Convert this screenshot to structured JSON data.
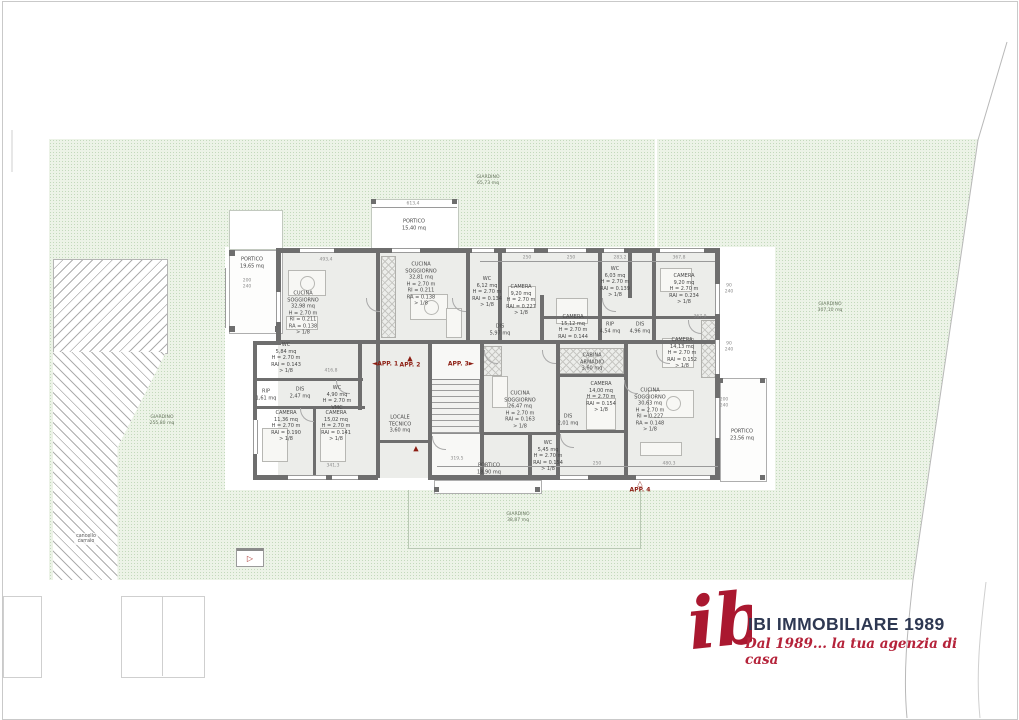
{
  "colors": {
    "wall_grey": "#6e6e6e",
    "garden_green": "#ecf3e7",
    "marker_red": "#8c1d12",
    "logo_red": "#aa1830",
    "logo_navy": "#2e3852"
  },
  "garden": {
    "labels": [
      {
        "id": "garden-top",
        "text": "GIARDINO\n65,73 mq",
        "x": 488,
        "y": 181
      },
      {
        "id": "garden-right",
        "text": "GIARDINO\n307,10 mq",
        "x": 830,
        "y": 308
      },
      {
        "id": "garden-left",
        "text": "GIARDINO\n255,80 mq",
        "x": 162,
        "y": 421
      },
      {
        "id": "garden-bottom",
        "text": "GIARDINO\n38,87 mq",
        "x": 518,
        "y": 518
      }
    ],
    "gate_label": "cancello\ncarraio"
  },
  "rooms": [
    {
      "id": "portico-tl",
      "x": 252,
      "y": 263,
      "lines": [
        "PORTICO",
        "19,65 mq"
      ]
    },
    {
      "id": "portico-top",
      "x": 414,
      "y": 225,
      "lines": [
        "PORTICO",
        "15,40 mq"
      ]
    },
    {
      "id": "cucina-app1",
      "x": 303,
      "y": 313,
      "lines": [
        "CUCINA",
        "SOGGIORNO",
        "32,98 mq",
        "H = 2.70 m",
        "RI = 0.211",
        "RA = 0.138",
        "> 1/8"
      ]
    },
    {
      "id": "cucina-app2",
      "x": 421,
      "y": 284,
      "lines": [
        "CUCINA",
        "SOGGIORNO",
        "32,81 mq",
        "H = 2.70 m",
        "RI = 0.211",
        "RA = 0.138",
        "> 1/8"
      ]
    },
    {
      "id": "wc-612",
      "x": 487,
      "y": 292,
      "lines": [
        "WC",
        "6,12 mq",
        "H = 2.70 m",
        "RAI = 0.134",
        "> 1/8"
      ]
    },
    {
      "id": "camera-920l",
      "x": 521,
      "y": 300,
      "lines": [
        "CAMERA",
        "9,20 mq",
        "H = 2.70 m",
        "RAI = 0.227",
        "> 1/8"
      ]
    },
    {
      "id": "wc-603",
      "x": 615,
      "y": 282,
      "lines": [
        "WC",
        "6,03 mq",
        "H = 2.70 m",
        "RAI = 0.139",
        "> 1/8"
      ]
    },
    {
      "id": "camera-920r",
      "x": 684,
      "y": 289,
      "lines": [
        "CAMERA",
        "9,20 mq",
        "H = 2.70 m",
        "RAI = 0.234",
        "> 1/8"
      ]
    },
    {
      "id": "dis-597",
      "x": 500,
      "y": 330,
      "lines": [
        "DIS",
        "5,97 mq"
      ]
    },
    {
      "id": "camera-1512",
      "x": 573,
      "y": 327,
      "lines": [
        "CAMERA",
        "15,12 mq",
        "H = 2.70 m",
        "RAI = 0.144"
      ]
    },
    {
      "id": "rip-454",
      "x": 610,
      "y": 328,
      "lines": [
        "RIP",
        "4,54 mq"
      ]
    },
    {
      "id": "dis-496",
      "x": 640,
      "y": 328,
      "lines": [
        "DIS",
        "4,96 mq"
      ]
    },
    {
      "id": "camera-1413",
      "x": 682,
      "y": 353,
      "lines": [
        "CAMERA",
        "14,13 mq",
        "H = 2.70 m",
        "RAI = 0.152",
        "> 1/8"
      ]
    },
    {
      "id": "wc-584",
      "x": 286,
      "y": 358,
      "lines": [
        "WC",
        "5,84 mq",
        "H = 2.70 m",
        "RAI = 0.143",
        "> 1/8"
      ]
    },
    {
      "id": "rip-161",
      "x": 266,
      "y": 395,
      "lines": [
        "RIP",
        "1,61 mq"
      ]
    },
    {
      "id": "dis-247",
      "x": 300,
      "y": 393,
      "lines": [
        "DIS",
        "2,47 mq"
      ]
    },
    {
      "id": "wc-490",
      "x": 337,
      "y": 398,
      "lines": [
        "WC",
        "4,90 mq",
        "H = 2.70 m",
        "VMC"
      ]
    },
    {
      "id": "camera-1136",
      "x": 286,
      "y": 426,
      "lines": [
        "CAMERA",
        "11,36 mq",
        "H = 2.70 m",
        "RAI = 0.190",
        "> 1/8"
      ]
    },
    {
      "id": "camera-1502",
      "x": 336,
      "y": 426,
      "lines": [
        "CAMERA",
        "15,02 mq",
        "H = 2.70 m",
        "RAI = 0.141",
        "> 1/8"
      ]
    },
    {
      "id": "locale-tecnico",
      "x": 400,
      "y": 424,
      "lines": [
        "LOCALE",
        "TECNICO",
        "3,60 mq"
      ]
    },
    {
      "id": "portico-1890",
      "x": 489,
      "y": 469,
      "lines": [
        "PORTICO",
        "18,90 mq"
      ]
    },
    {
      "id": "cucina-app4",
      "x": 520,
      "y": 410,
      "lines": [
        "CUCINA",
        "SOGGIORNO",
        "26,47 mq",
        "H = 2.70 m",
        "RAI = 0.163",
        "> 1/8"
      ]
    },
    {
      "id": "dis-201",
      "x": 568,
      "y": 420,
      "lines": [
        "DIS",
        "2,01 mq"
      ]
    },
    {
      "id": "camera-1400",
      "x": 601,
      "y": 397,
      "lines": [
        "CAMERA",
        "14,00 mq",
        "H = 2.70 m",
        "RAI = 0.154",
        "> 1/8"
      ]
    },
    {
      "id": "cabina-armadio",
      "x": 592,
      "y": 362,
      "lines": [
        "CABINA",
        "ARMADIO",
        "3,60 mq"
      ]
    },
    {
      "id": "wc-545",
      "x": 548,
      "y": 456,
      "lines": [
        "WC",
        "5,45 mq",
        "H = 2.70 m",
        "RAI = 0.154",
        "> 1/8"
      ]
    },
    {
      "id": "cucina-app5",
      "x": 650,
      "y": 410,
      "lines": [
        "CUCINA",
        "SOGGIORNO",
        "30,63 mq",
        "H = 2.70 m",
        "RI = 0.227",
        "RA = 0.148",
        "> 1/8"
      ]
    },
    {
      "id": "portico-2356",
      "x": 742,
      "y": 435,
      "lines": [
        "PORTICO",
        "23,56 mq"
      ]
    }
  ],
  "markers": [
    {
      "id": "app-1",
      "label": "APP. 1",
      "glyph": "◄",
      "pos": "left",
      "x": 385,
      "y": 364
    },
    {
      "id": "app-2",
      "label": "APP. 2",
      "glyph": "▲",
      "pos": "top",
      "x": 410,
      "y": 362
    },
    {
      "id": "app-3",
      "label": "APP. 3",
      "glyph": "►",
      "pos": "right",
      "x": 461,
      "y": 364
    },
    {
      "id": "app-4",
      "label": "APP. 4",
      "glyph": "△",
      "pos": "top",
      "x": 640,
      "y": 487
    },
    {
      "id": "entry-arrow",
      "label": "",
      "glyph": "▲",
      "pos": "top",
      "x": 416,
      "y": 449
    }
  ],
  "entry_gate_icon": "▷",
  "dimensions": [
    {
      "t": "613,4",
      "x": 413,
      "y": 204
    },
    {
      "t": "493,4",
      "x": 326,
      "y": 260
    },
    {
      "t": "250",
      "x": 527,
      "y": 258
    },
    {
      "t": "250",
      "x": 571,
      "y": 258
    },
    {
      "t": "283,2",
      "x": 620,
      "y": 258
    },
    {
      "t": "367,8",
      "x": 679,
      "y": 258
    },
    {
      "t": "200",
      "x": 247,
      "y": 281
    },
    {
      "t": "240",
      "x": 247,
      "y": 287
    },
    {
      "t": "90",
      "x": 729,
      "y": 286
    },
    {
      "t": "240",
      "x": 729,
      "y": 292
    },
    {
      "t": "90",
      "x": 729,
      "y": 344
    },
    {
      "t": "240",
      "x": 729,
      "y": 350
    },
    {
      "t": "200",
      "x": 724,
      "y": 400
    },
    {
      "t": "240",
      "x": 724,
      "y": 406
    },
    {
      "t": "416,8",
      "x": 331,
      "y": 371
    },
    {
      "t": "341,3",
      "x": 333,
      "y": 466
    },
    {
      "t": "319,5",
      "x": 457,
      "y": 459
    },
    {
      "t": "250",
      "x": 597,
      "y": 464
    },
    {
      "t": "480,3",
      "x": 669,
      "y": 464
    },
    {
      "t": "367,9",
      "x": 700,
      "y": 317
    }
  ],
  "logo": {
    "monogram": "ib",
    "title": "IBI IMMOBILIARE 1989",
    "tagline": "Dal 1989... la tua agenzia di casa"
  }
}
